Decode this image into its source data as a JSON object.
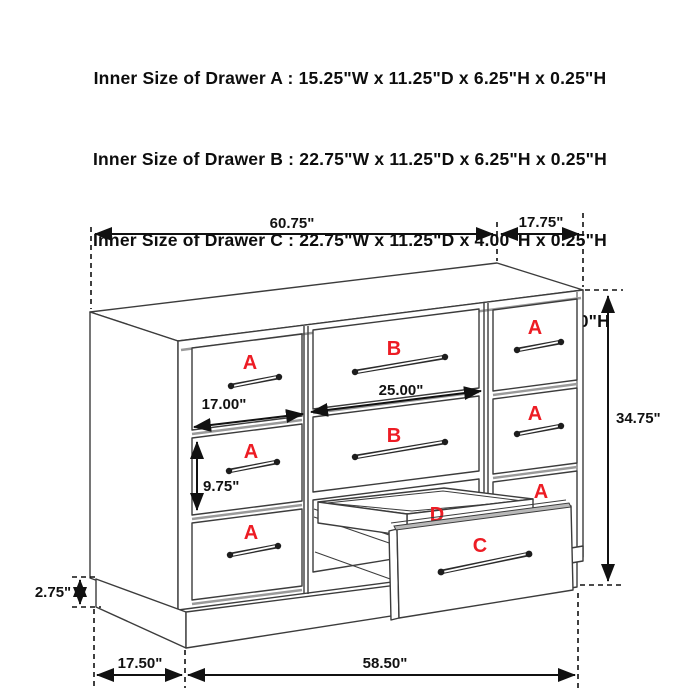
{
  "header": {
    "lines": [
      "Inner Size of Drawer A : 15.25\"W x 11.25\"D x 6.25\"H x 0.25\"H",
      "Inner Size of Drawer B : 22.75\"W x 11.25\"D x 6.25\"H x 0.25\"H",
      "Inner Size of Drawer C : 22.75\"W x 11.25\"D x 4.00\"H x 0.25\"H",
      "Inner Size of Drawer  D : 22.50\"W x 10.75\"D x 1.75\"H x 0.50\"H"
    ]
  },
  "diagram": {
    "dimensions": {
      "top_width": "60.75\"",
      "top_depth": "17.75\"",
      "height": "34.75\"",
      "drawer_a_width": "17.00\"",
      "drawer_b_width": "25.00\"",
      "drawer_a_height": "9.75\"",
      "base_height": "2.75\"",
      "base_depth": "17.50\"",
      "base_width": "58.50\""
    },
    "drawer_labels": {
      "a": "A",
      "b": "B",
      "c": "C",
      "d": "D"
    },
    "colors": {
      "label_red": "#ed1c24",
      "line": "#3c3c3c",
      "dimension": "#111111"
    }
  }
}
